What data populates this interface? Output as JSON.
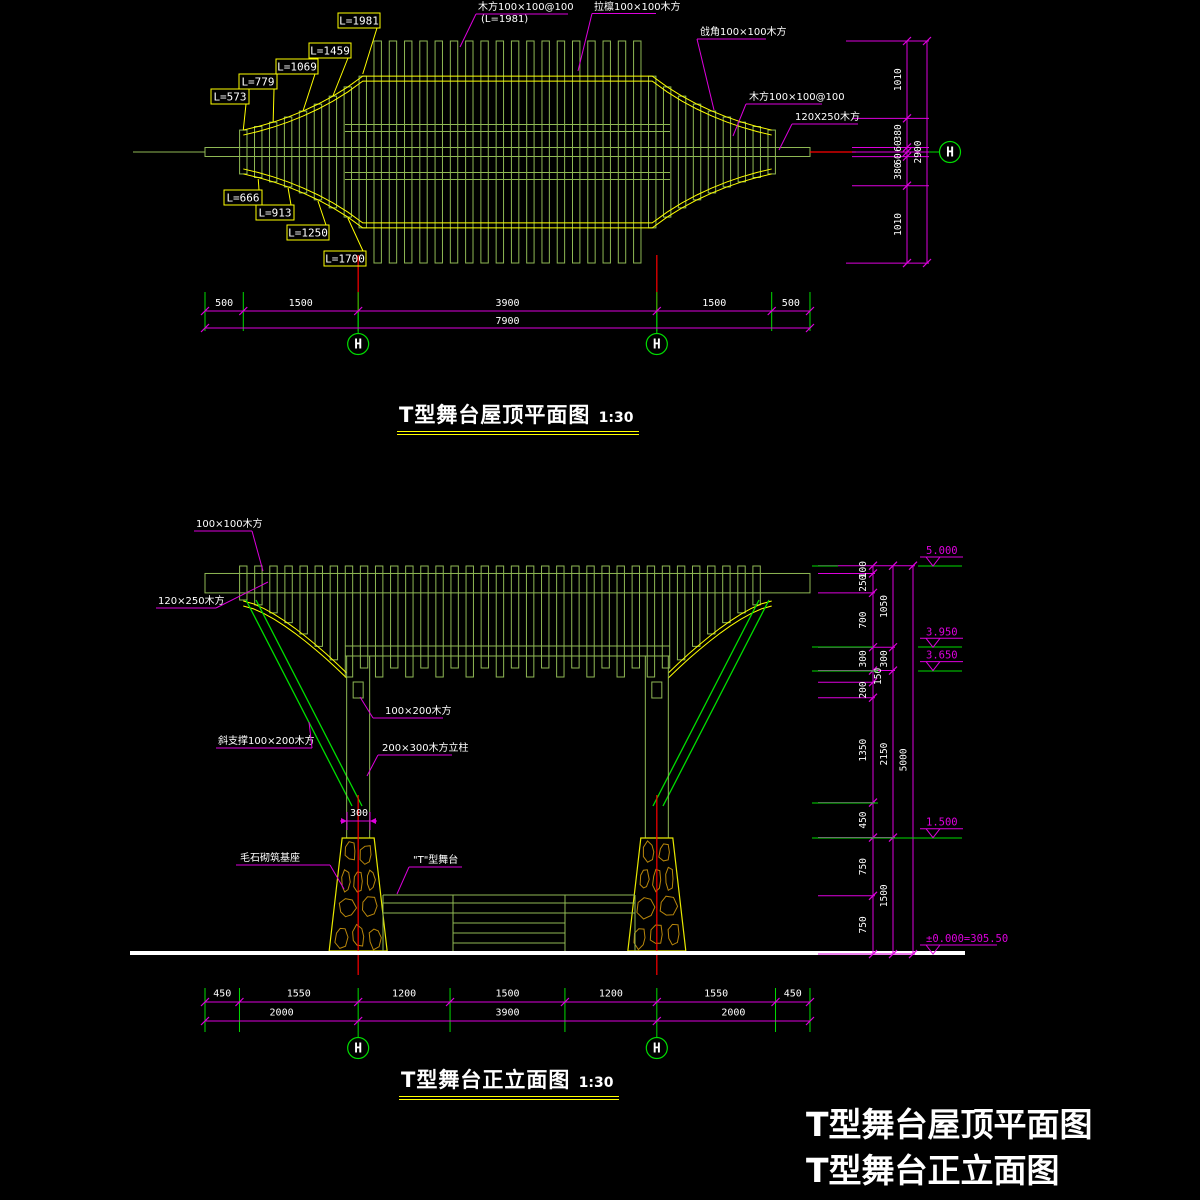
{
  "colors": {
    "bg": "#000000",
    "slat_green": "#8fb854",
    "bright_green": "#00dd00",
    "yellow": "#ffff00",
    "dim_magenta": "#dd00dd",
    "red": "#ff0000",
    "stone": "#b8860b",
    "white": "#ffffff"
  },
  "plan": {
    "title": "T型舞台屋顶平面图",
    "scale_note": "1:30",
    "labels": {
      "slat_top": "木方100×100@100",
      "slat_top_sub": "(L=1981)",
      "purlin": "拉檩100×100木方",
      "hip": "戗角100×100木方",
      "slat_right": "木方100×100@100",
      "beam": "120X250木方"
    },
    "length_labels_upper": [
      "L=573",
      "L=779",
      "L=1069",
      "L=1459",
      "L=1981"
    ],
    "length_labels_lower": [
      "L=666",
      "L=913",
      "L=1250",
      "L=1700"
    ],
    "dims_bottom": [
      500,
      1500,
      3900,
      1500,
      500
    ],
    "dims_bottom_total": 7900,
    "dims_right": [
      1010,
      380,
      60,
      60,
      380,
      1010
    ],
    "dims_right_total": 2900,
    "grid_marker": "H"
  },
  "elevation": {
    "title": "T型舞台正立面图",
    "scale_note": "1:30",
    "labels": {
      "slat": "100×100木方",
      "beam": "120×250木方",
      "brace": "斜支撑100×200木方",
      "purlin": "100×200木方",
      "column": "200×300木方立柱",
      "column_width": "300",
      "base": "毛石砌筑基座",
      "stage": "\"T\"型舞台"
    },
    "dims_bottom_row1": [
      450,
      1550,
      1200,
      1500,
      1200,
      1550,
      450
    ],
    "dims_bottom_row2": [
      2000,
      3900,
      2000
    ],
    "dims_right_inner": [
      100,
      250,
      700,
      300,
      150,
      200,
      1350,
      450,
      750,
      750
    ],
    "dims_right_mid": [
      1050,
      300,
      2150,
      1500
    ],
    "dims_right_outer": 5000,
    "levels": [
      "5.000",
      "3.950",
      "3.650",
      "1.500",
      "±0.000=305.50"
    ],
    "grid_marker": "H"
  },
  "footer": {
    "line1": "T型舞台屋顶平面图",
    "line2": "T型舞台正立面图"
  }
}
